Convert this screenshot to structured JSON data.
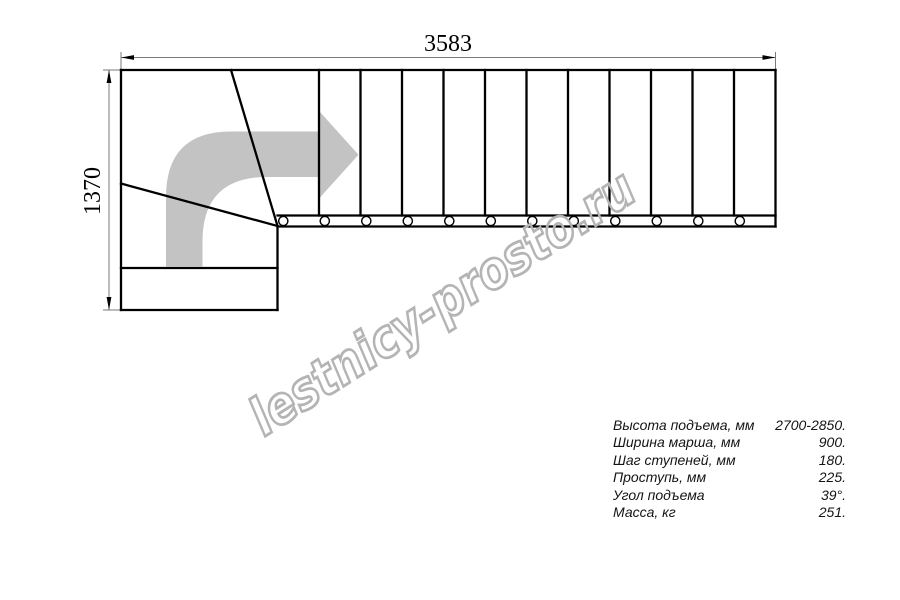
{
  "drawing": {
    "width_label": "3583",
    "height_label": "1370",
    "flight_steps": 12,
    "bolt_count": 12
  },
  "watermark": {
    "text": "lestnicy-prosto.ru"
  },
  "specs": {
    "rows": [
      {
        "label": "Высота подъема, мм",
        "value": "2700-2850."
      },
      {
        "label": "Ширина марша, мм",
        "value": "900."
      },
      {
        "label": "Шаг ступеней, мм",
        "value": "180."
      },
      {
        "label": "Проступь, мм",
        "value": "225."
      },
      {
        "label": "Угол подъема",
        "value": "39°."
      },
      {
        "label": "Масса, кг",
        "value": "251."
      }
    ]
  },
  "colors": {
    "background": "#ffffff",
    "line": "#000000",
    "thin_line": "#7a7a7a",
    "arrow_fill": "#c3c3c3",
    "watermark": "#b4b4b4",
    "spec_text": "#141414"
  }
}
